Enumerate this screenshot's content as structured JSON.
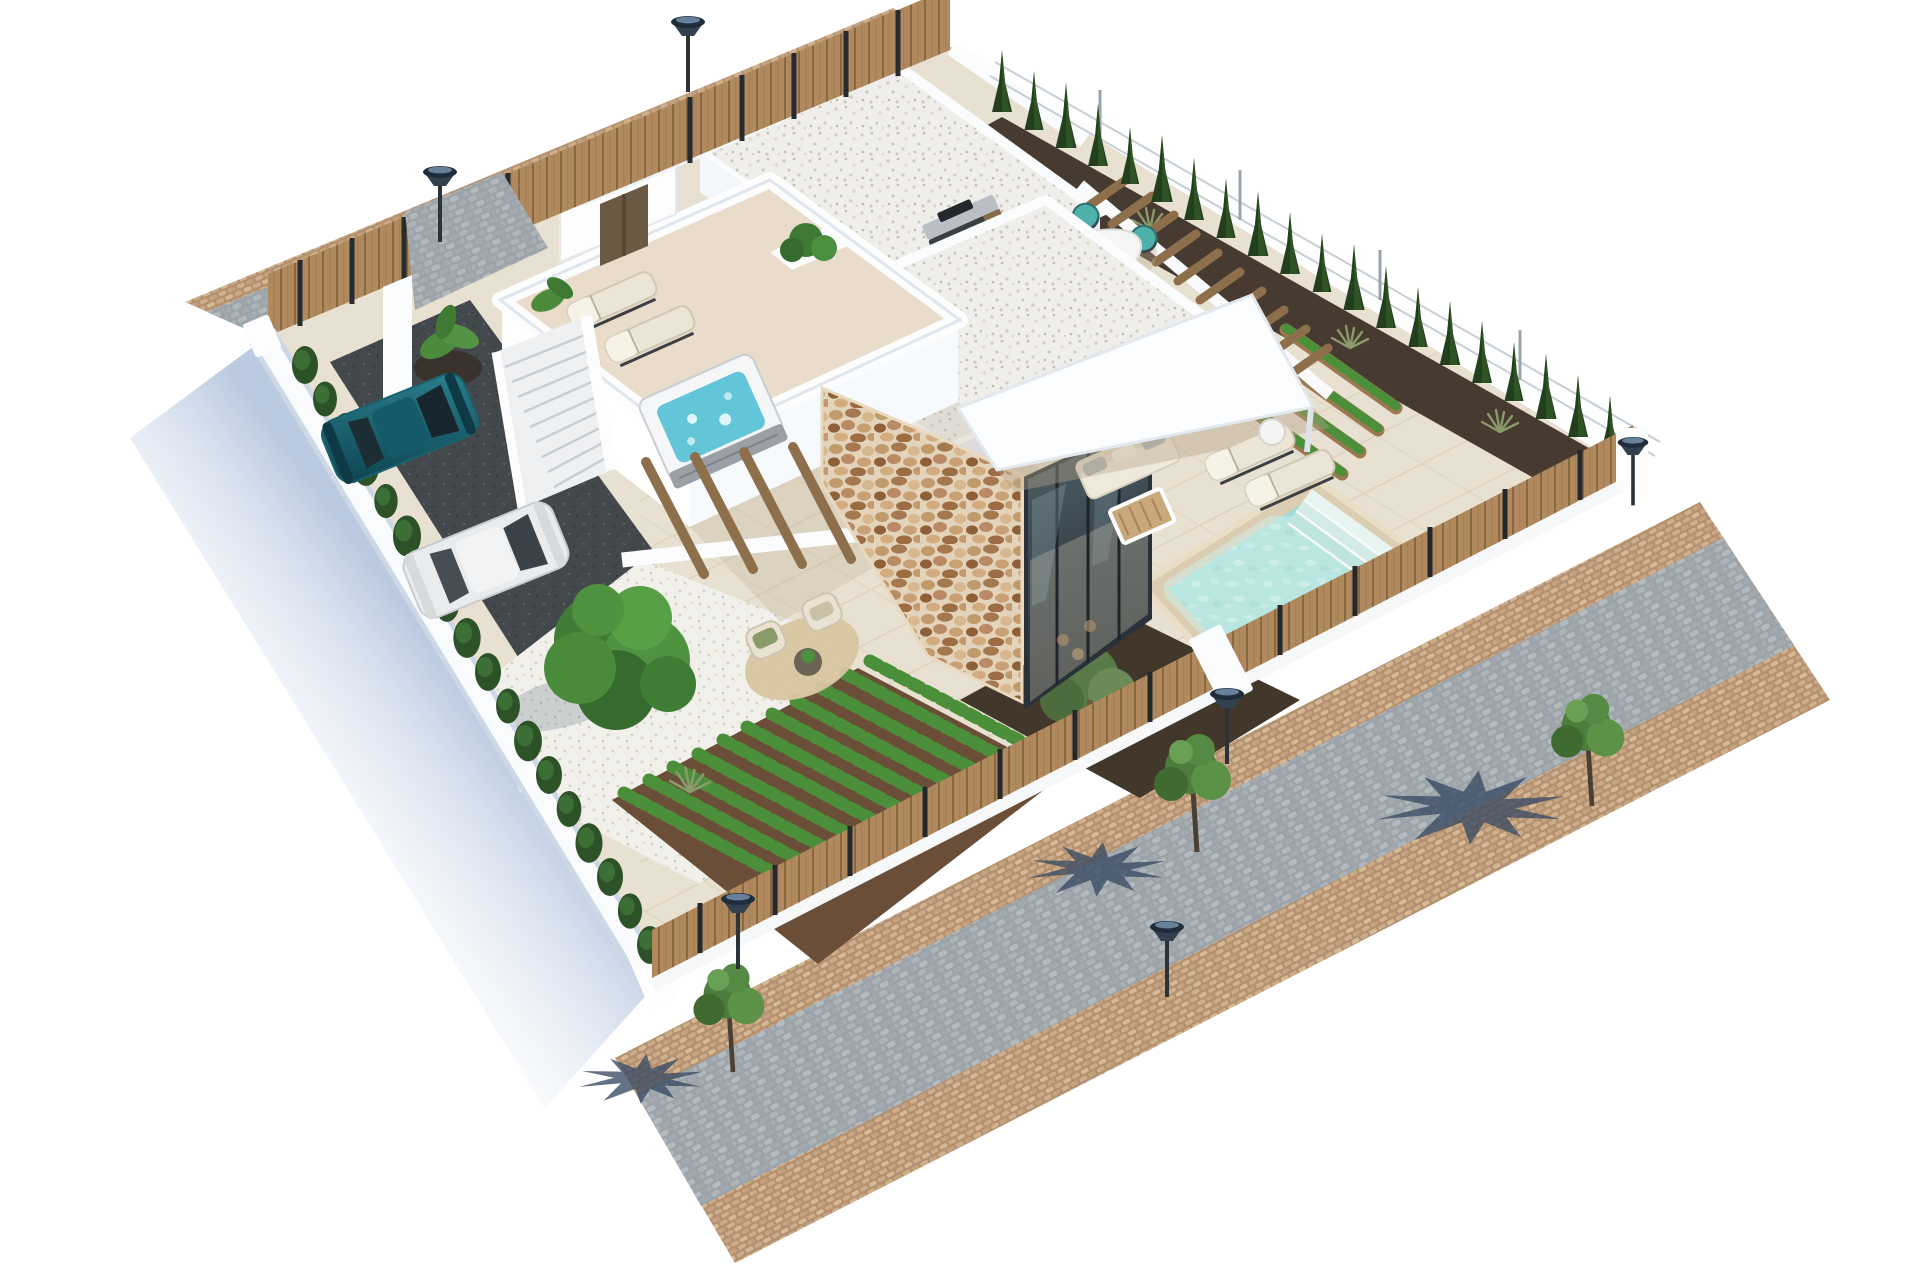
{
  "meta": {
    "title": "Aerial 3D architectural render of a modern single-storey villa plot with pool, roof terrace, gardens, parking and surrounding streets",
    "view": "isometric aerial",
    "background": "#ffffff"
  },
  "palette": {
    "terrace": "#e8e0d0",
    "terrace_shadow": "#b4a386",
    "roof_gravel": "#efeeea",
    "white_gravel": "#f1f0ea",
    "street_gray": "#9ba3a8",
    "sidewalk_tan": "#b3906f",
    "wood": "#b08a5e",
    "wood_dark": "#8a683f",
    "hedge_green": "#2e5227",
    "cypress_green": "#243f1d",
    "tree_green": "#4a8a3b",
    "veg_green": "#4c8f3a",
    "soil_brown": "#6b4e37",
    "mulch_dark": "#42372b",
    "pool_water": "#9edbd5",
    "pool_coping": "#dbcdb2",
    "jacuzzi_water": "#62c5d8",
    "shadow_blue": "#b7c7de",
    "tree_shadow": "#394a63",
    "asphalt": "#43484d",
    "stone_mortar": "#e3d3ba",
    "wall_white": "#f8fafc",
    "car_teal": "#19636f",
    "car_white": "#e9ebec",
    "chair_teal": "#4db0aa",
    "cushion_cream": "#ece5d6",
    "lamp_dark": "#1f2d3a"
  },
  "scene": {
    "cars": 2,
    "street_lamps": 6,
    "cypress_trees": 20,
    "dining_chairs": 8,
    "roof_loungers": 2,
    "pool_loungers": 2,
    "sidewalk_trees": 3,
    "vegetable_rows": 11,
    "hot_tub": 1,
    "swimming_pool": 1
  }
}
